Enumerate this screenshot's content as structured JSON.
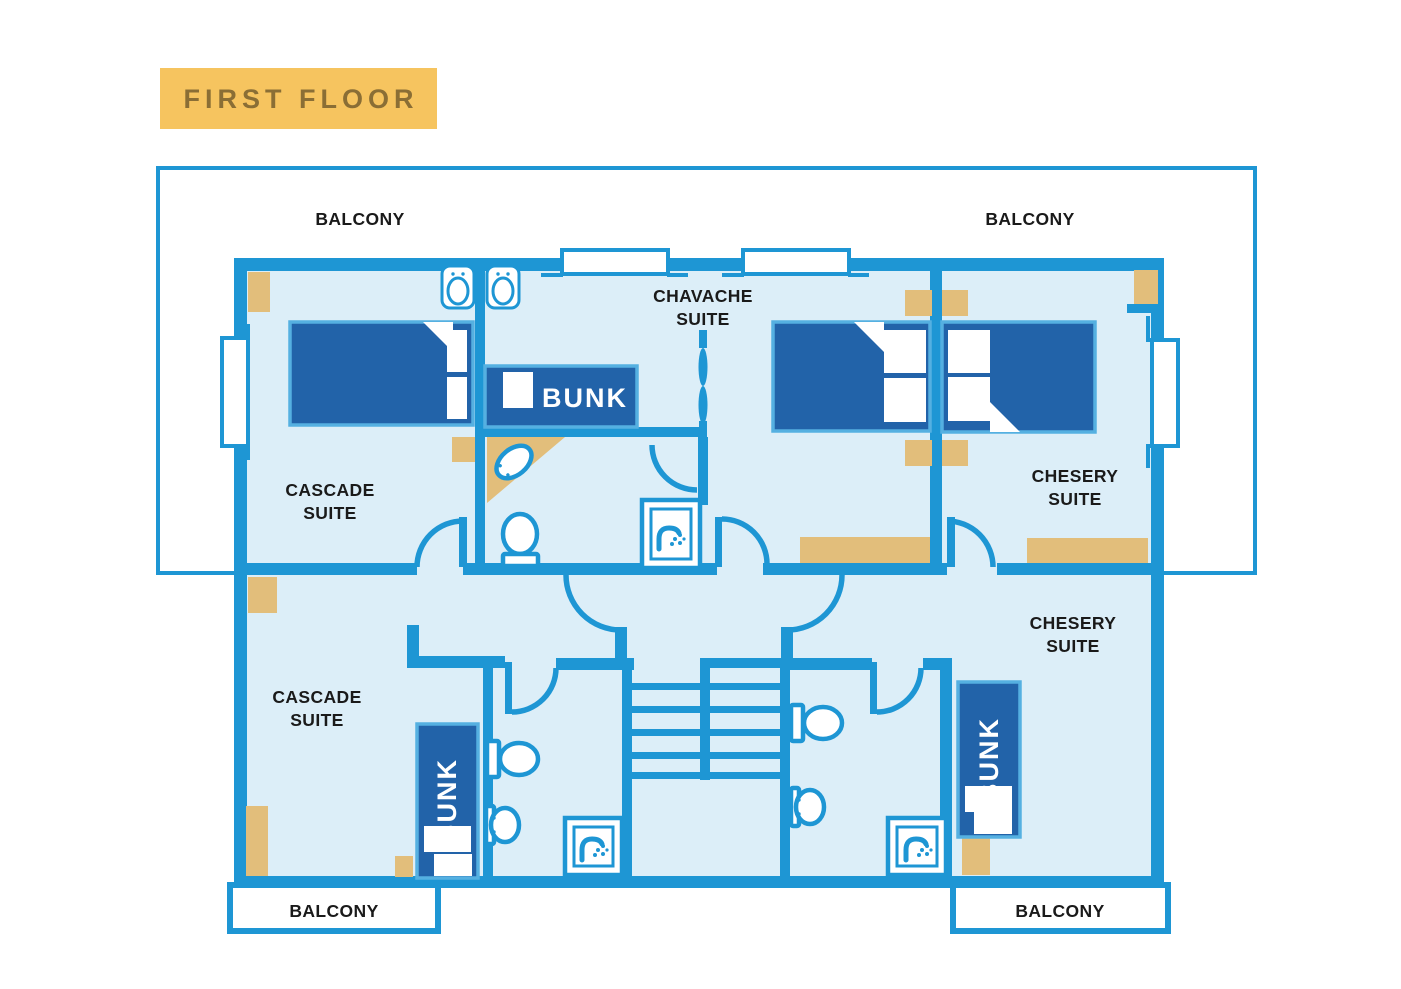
{
  "title": {
    "label": "FIRST FLOOR"
  },
  "colors": {
    "wall": "#1E96D4",
    "room": "#DCEEF8",
    "bed": "#2263A9",
    "bed_border": "#55B0E1",
    "tan": "#E2BE7B",
    "title_bg": "#F6C45F",
    "title_text": "#8A6E35",
    "text": "#1A1A1A"
  },
  "labels": {
    "balconies": {
      "top_left": "BALCONY",
      "top_right": "BALCONY",
      "bottom_left": "BALCONY",
      "bottom_right": "BALCONY"
    },
    "suites": {
      "cascade_upper": {
        "line1": "CASCADE",
        "line2": "SUITE"
      },
      "cascade_lower": {
        "line1": "CASCADE",
        "line2": "SUITE"
      },
      "chavache": {
        "line1": "CHAVACHE",
        "line2": "SUITE"
      },
      "chesery_upper": {
        "line1": "CHESERY",
        "line2": "SUITE"
      },
      "chesery_lower": {
        "line1": "CHESERY",
        "line2": "SUITE"
      }
    },
    "bunks": {
      "chavache": "BUNK",
      "cascade": "BUNK",
      "chesery": "BUNK"
    }
  },
  "fixtures": {
    "showers": 3,
    "toilets": 3,
    "sinks": 5,
    "staircase": 1,
    "icon_names": [
      "shower-icon",
      "toilet-icon",
      "sink-icon",
      "bifold-door-icon",
      "stairs",
      "window",
      "door-arc"
    ]
  }
}
